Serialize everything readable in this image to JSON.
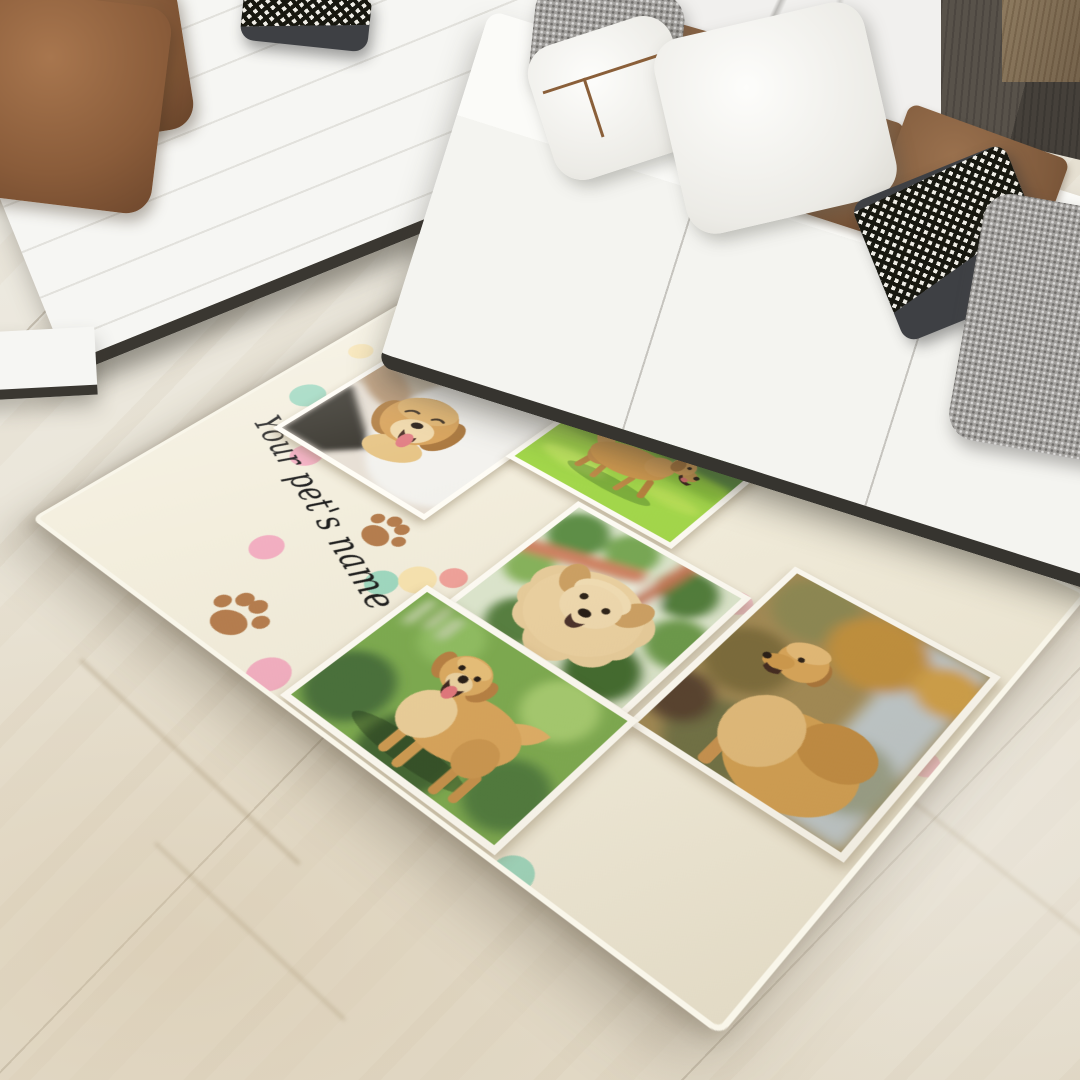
{
  "scene": {
    "setting": "living-room with white sectional sofa on marble floor",
    "product": "personalized pet photo collage rug"
  },
  "rug": {
    "name_text": "Your pet's name",
    "photos": [
      {
        "id": "photo-1",
        "subject": "golden retriever petted by owner indoors"
      },
      {
        "id": "photo-2",
        "subject": "golden retriever playing on bright grass"
      },
      {
        "id": "photo-3",
        "subject": "fluffy golden retriever by coral fence"
      },
      {
        "id": "photo-4",
        "subject": "golden retriever looking up in autumn field"
      },
      {
        "id": "photo-5",
        "subject": "golden retriever standing on lawn"
      }
    ],
    "paw_print_count": 2,
    "dot_colors_used": [
      "pink",
      "mint",
      "yellow",
      "coral",
      "pale-pink"
    ]
  },
  "colors": {
    "rug-bg": "#f3eedd",
    "rug-edge": "#f9f6ea",
    "frame": "#fffdf6",
    "paw": "#b57d4e",
    "ink": "#1d1d1d",
    "dot-pink": "#f3afc2",
    "dot-mint": "#9fd8c0",
    "dot-yellow": "#f7e3b0",
    "dot-coral": "#f0a29b",
    "dot-pale-pink": "#f5c6ce",
    "sofa": "#f6f6f3",
    "sofa-seam": "#e2e1dc",
    "pillow-brown": "#8a5c3a",
    "pillow-charcoal": "#3e4044",
    "pillow-gray": "#a3a19e",
    "floor": "#e8e2d5",
    "marble-wall": "#f1f0ee",
    "wood-dark": "#58524a",
    "wood-light": "#8d7a5f"
  }
}
